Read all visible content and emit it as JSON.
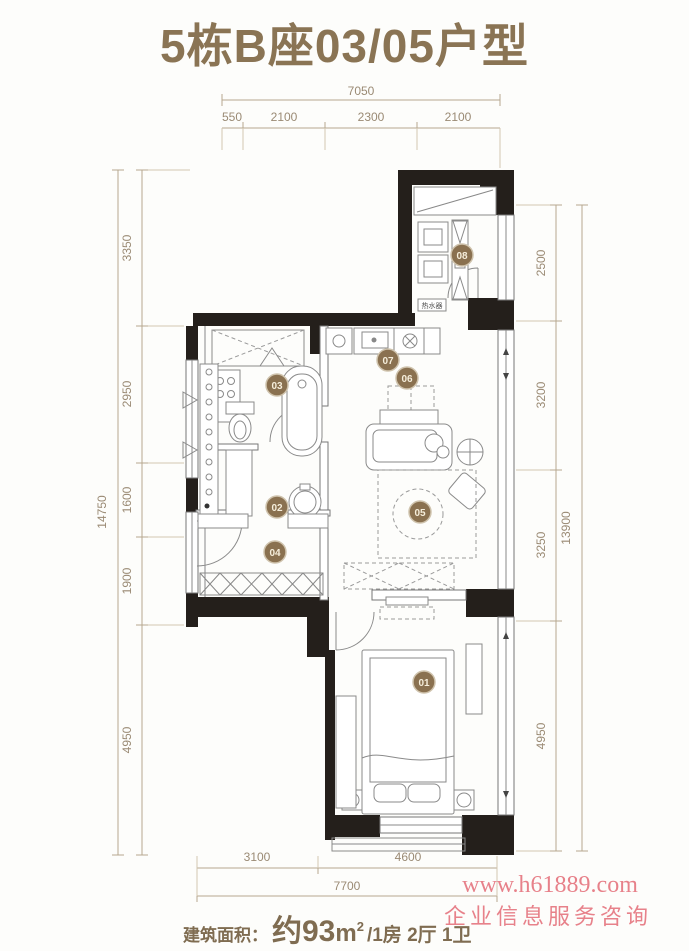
{
  "title": "5栋B座03/05户型",
  "dims": {
    "top": {
      "overall": "7050",
      "segments": [
        "550",
        "2100",
        "2300",
        "2100"
      ]
    },
    "left": {
      "overall": "14750",
      "segments": [
        "3350",
        "2950",
        "1600",
        "1900",
        "4950"
      ]
    },
    "right": {
      "overall": "13900",
      "segments": [
        "2500",
        "3200",
        "3250",
        "4950"
      ]
    },
    "bottom": {
      "overall": "7700",
      "segments": [
        "3100",
        "4600"
      ]
    }
  },
  "room_numbers": [
    "01",
    "02",
    "03",
    "04",
    "05",
    "06",
    "07",
    "08"
  ],
  "labels": {
    "water_heater": "热水器"
  },
  "footer": {
    "area_label": "建筑面积：",
    "area_value": "约93",
    "area_unit": "m",
    "area_exp": "2",
    "suffix": "/1房 2厅 1卫"
  },
  "watermark": {
    "line1": "www.h61889.com",
    "line2": "企业信息服务咨询"
  },
  "colors": {
    "title": "#8a7454",
    "dimension": "#9a8a74",
    "wall": "#241f1b",
    "room_badge": "#8a7150",
    "watermark": "#e5747e"
  }
}
